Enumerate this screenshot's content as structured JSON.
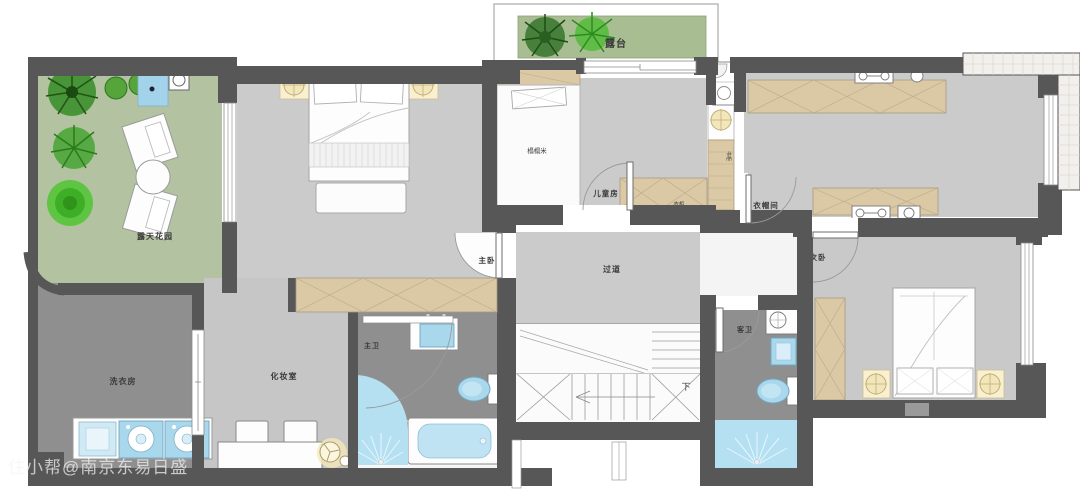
{
  "title": "二层户型平面图",
  "watermark": "住小帮@南京东易日盛",
  "labels": {
    "terrace": "露台",
    "garden": "露天花园",
    "laundry": "洗衣房",
    "dressing": "化妆室",
    "master_bath": "主卫",
    "master_bedroom": "主卧",
    "corridor": "过道",
    "tatami": "榻榻米",
    "kids_room": "儿童房",
    "kids_wardrobe": "衣柜",
    "bookcase": "书柜",
    "cloakroom": "衣帽间",
    "second_bedroom": "次卧",
    "guest_bath": "客卫",
    "stairs_down": "下"
  },
  "colors": {
    "wall": "#575757",
    "floor_light": "#cbcbcb",
    "floor_dark": "#8f8f8f",
    "garden_green": "#b3c2a0",
    "terrace_green": "#a8bd92",
    "cabinet_tan": "#dbc9a5",
    "fixture_blue": "#a9d7ec",
    "shower_blue": "#b4e0f2",
    "lamp_yellow": "#f3e6bb",
    "plant_green": "#3f9a2f"
  }
}
